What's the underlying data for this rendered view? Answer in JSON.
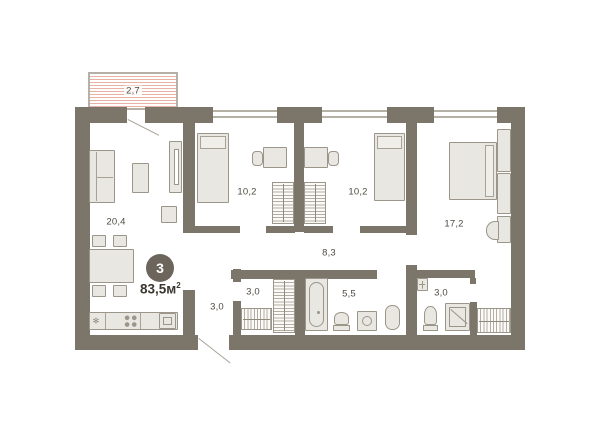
{
  "plan": {
    "type": "apartment-floor-plan",
    "summary": {
      "rooms_count": "3",
      "area_value": "83,5",
      "area_unit": "м",
      "area_exp": "2"
    },
    "balcony": {
      "area": "2,7"
    },
    "rooms": {
      "living": {
        "name": "living-kitchen",
        "area": "20,4"
      },
      "bedroom1": {
        "name": "bedroom-1",
        "area": "10,2"
      },
      "bedroom2": {
        "name": "bedroom-2",
        "area": "10,2"
      },
      "master": {
        "name": "master-bedroom",
        "area": "17,2"
      },
      "hallway": {
        "name": "hallway",
        "area": "8,3"
      },
      "corridor": {
        "name": "entry-corridor",
        "area": "3,0"
      },
      "closet": {
        "name": "closet",
        "area": "3,0"
      },
      "bathroom": {
        "name": "bathroom",
        "area": "5,5"
      },
      "ensuite": {
        "name": "ensuite-bathroom",
        "area": "3,0"
      }
    },
    "colors": {
      "wall": "#7c756a",
      "furniture_fill": "#e9e7e1",
      "furniture_stroke": "#9b958a",
      "balcony_hatch": "#e7b1a3",
      "label_text": "#4e4a42",
      "badge_bg": "#6b655c",
      "badge_text": "#ffffff"
    }
  }
}
